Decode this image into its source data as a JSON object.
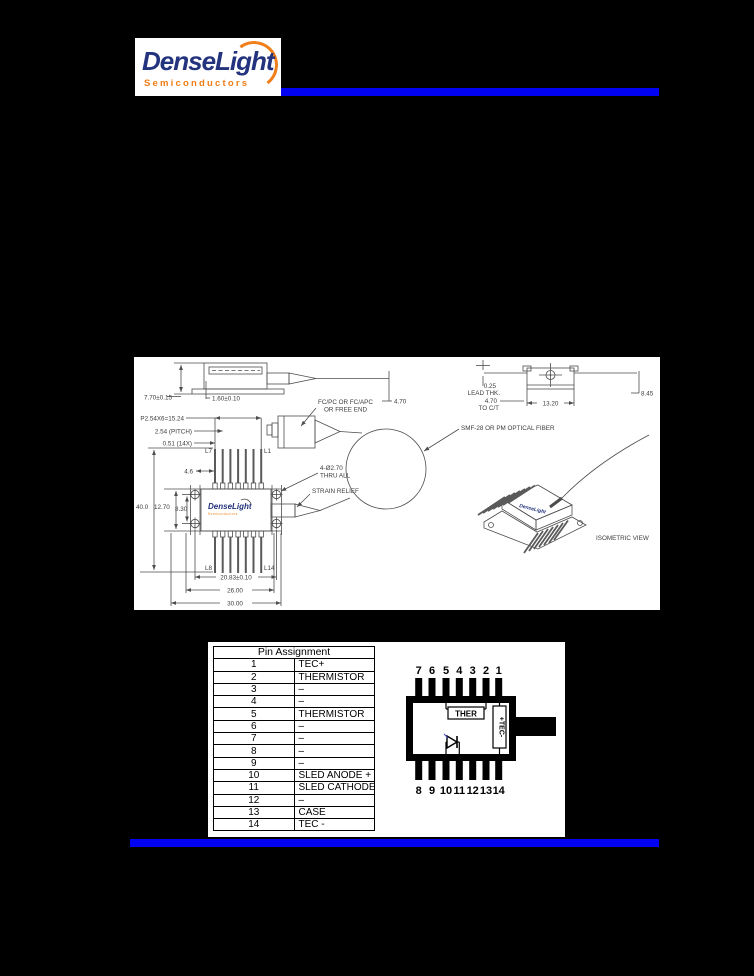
{
  "page": {
    "background": "#000000",
    "accent_blue": "#0202f2"
  },
  "logo": {
    "brand": "DenseLight",
    "subtitle": "Semiconductors",
    "brand_color": "#23337d",
    "accent_orange": "#ee7d15"
  },
  "drawing": {
    "side_view": {
      "height_dim": "7.70±0.15",
      "base_dim": "1.60±0.10",
      "fiber_dim": "4.70"
    },
    "end_view": {
      "lead_thk_value": "0.25",
      "lead_thk_label": "LEAD THK.",
      "to_ct_value": "4.70",
      "to_ct_label": "TO C/T",
      "width_dim": "13.20",
      "height_dim": "8.45"
    },
    "top_view": {
      "pin_row_dim": "P2.54X6=15.24",
      "pitch_dim": "2.54 (PITCH)",
      "lead_width_dim": "0.51 (14X)",
      "pin_label_l7": "L7",
      "pin_label_l1": "L1",
      "pin_label_l8": "L8",
      "pin_label_l14": "L14",
      "lead_length_dim": "4.6",
      "overall_dim": "40.0",
      "body_width_dim": "12.70",
      "hole_spacing_v_dim": "8.30",
      "hole_spacing_h_dim": "20.83±0.10",
      "flange_width_dim": "26.00",
      "body_length_dim": "30.00",
      "holes_note_line1": "4-Ø2.70",
      "holes_note_line2": "THRU ALL",
      "strain_relief_label": "STRAIN RELIEF"
    },
    "connector": {
      "ferrule_note_line1": "FC/PC OR FC/APC",
      "ferrule_note_line2": "OR FREE END",
      "fiber_note": "SMF-28 OR PM OPTICAL FIBER"
    },
    "isometric": {
      "caption": "ISOMETRIC VIEW"
    }
  },
  "pin_table": {
    "title": "Pin Assignment",
    "rows": [
      [
        "1",
        "TEC+"
      ],
      [
        "2",
        "THERMISTOR"
      ],
      [
        "3",
        "–"
      ],
      [
        "4",
        "–"
      ],
      [
        "5",
        "THERMISTOR"
      ],
      [
        "6",
        "–"
      ],
      [
        "7",
        "–"
      ],
      [
        "8",
        "–"
      ],
      [
        "9",
        "–"
      ],
      [
        "10",
        "SLED ANODE +"
      ],
      [
        "11",
        "SLED CATHODE -"
      ],
      [
        "12",
        "–"
      ],
      [
        "13",
        "CASE"
      ],
      [
        "14",
        "TEC -"
      ]
    ]
  },
  "pin_diagram": {
    "top_pins": [
      "7",
      "6",
      "5",
      "4",
      "3",
      "2",
      "1"
    ],
    "bottom_pins": [
      "8",
      "9",
      "10",
      "11",
      "12",
      "13",
      "14"
    ],
    "thermistor_label": "THER",
    "tec_label": "+TEC-"
  }
}
